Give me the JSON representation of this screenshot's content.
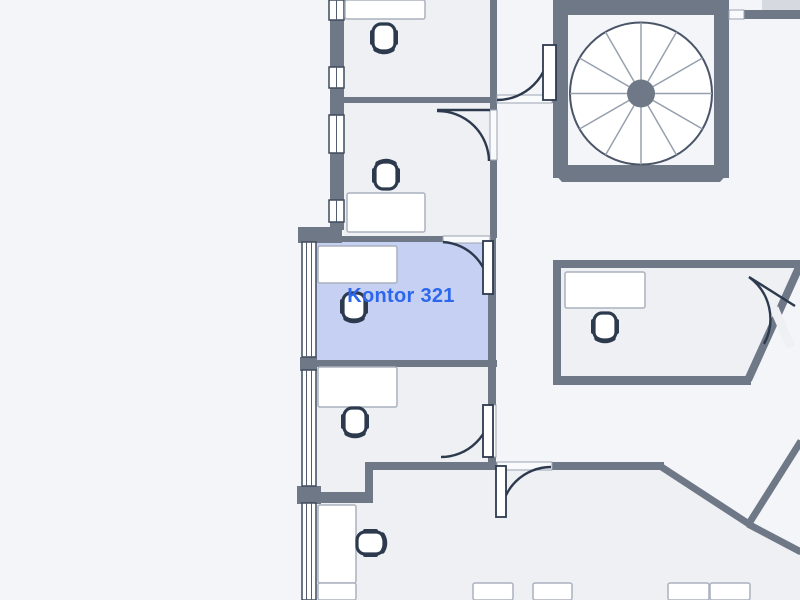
{
  "page": {
    "title": "Floor plan view",
    "background": "#f4f5f8"
  },
  "selected_room": {
    "label": "Kontor 321",
    "fill": "#c5d0f3",
    "label_color": "#2c67ee"
  },
  "palette": {
    "wall": "#6f7887",
    "room_fill": "#eef0f3",
    "furniture_dark": "#2d3a4e",
    "desk_fill": "#ffffff",
    "window_fill": "#ffffff",
    "stair_interior": "#f4f5f8",
    "annex_block": "#d6dae0"
  },
  "symbols": {
    "spiral_staircase": {
      "icon": "spiral-staircase-icon",
      "spokes": 12
    },
    "office_chairs": {
      "icon": "office-chair-icon",
      "count": 6
    },
    "desks": {
      "icon": "desk",
      "count": 11
    },
    "doors": {
      "icon": "door-swing-icon",
      "count": 6
    },
    "window_bands": {
      "icon": "window-band",
      "count": 7
    }
  }
}
